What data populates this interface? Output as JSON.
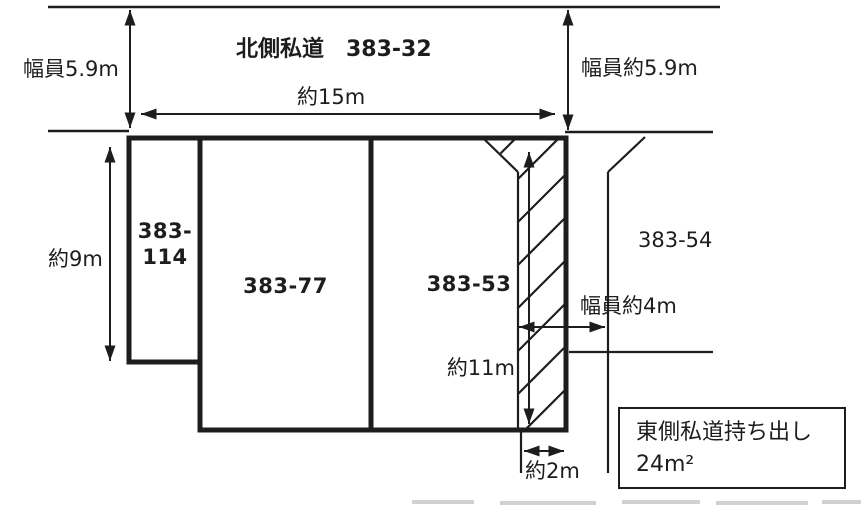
{
  "figure": {
    "type": "land-plot-survey-diagram",
    "colors": {
      "ink": "#1d1d1d",
      "paper": "#ffffff"
    },
    "north_road": {
      "title": "北側私道　383-32",
      "width_label_left": "幅員5.9m",
      "width_label_right": "幅員約5.9m"
    },
    "dimensions": {
      "frontage_top": "約15m",
      "depth_left": "約9m",
      "strip_length": "約11m",
      "east_road_width": "幅員約4m",
      "strip_width": "約2m"
    },
    "parcels": {
      "p114_line1": "383-",
      "p114_line2": "114",
      "p77": "383-77",
      "p53": "383-53",
      "p54": "383-54"
    },
    "note": {
      "line1": "東側私道持ち出し",
      "line2": "24m²"
    }
  }
}
